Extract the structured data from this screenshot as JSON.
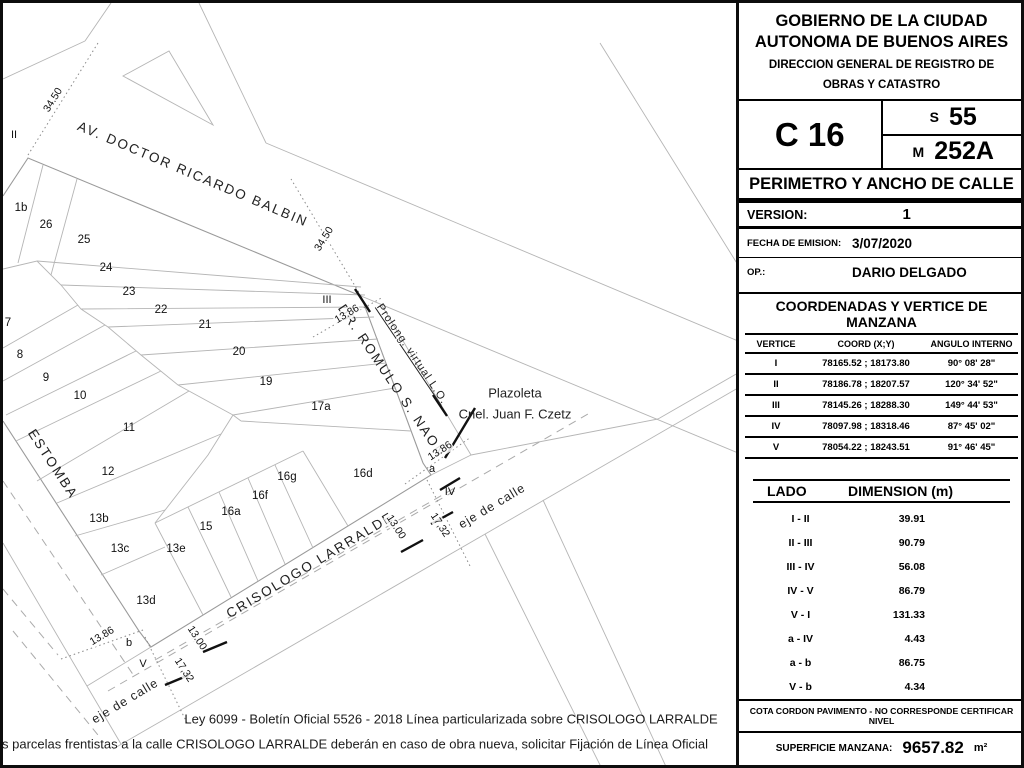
{
  "panel": {
    "org_line1": "GOBIERNO DE LA CIUDAD",
    "org_line2": "AUTONOMA DE BUENOS AIRES",
    "org_line3": "DIRECCION GENERAL DE REGISTRO DE",
    "org_line4": "OBRAS Y CATASTRO",
    "circunscripcion": "C 16",
    "seccion_prefix": "S",
    "seccion": "55",
    "manzana_prefix": "M",
    "manzana": "252A",
    "doc_title": "PERIMETRO Y ANCHO DE CALLE",
    "version_label": "VERSION:",
    "version": "1",
    "fecha_label": "FECHA DE EMISION:",
    "fecha": "3/07/2020",
    "op_label": "OP.:",
    "op": "DARIO DELGADO",
    "coords": {
      "title": "COORDENADAS Y VERTICE DE MANZANA",
      "headers": [
        "VERTICE",
        "COORD (X;Y)",
        "ANGULO INTERNO"
      ],
      "rows": [
        [
          "I",
          "78165.52 ; 18173.80",
          "90° 08' 28\""
        ],
        [
          "II",
          "78186.78 ; 18207.57",
          "120° 34' 52\""
        ],
        [
          "III",
          "78145.26 ; 18288.30",
          "149° 44' 53\""
        ],
        [
          "IV",
          "78097.98 ; 18318.46",
          "87° 45' 02\""
        ],
        [
          "V",
          "78054.22 ; 18243.51",
          "91° 46' 45\""
        ]
      ]
    },
    "lados": {
      "col1": "LADO",
      "col2": "DIMENSION (m)",
      "rows": [
        [
          "I - II",
          "39.91"
        ],
        [
          "II - III",
          "90.79"
        ],
        [
          "III - IV",
          "56.08"
        ],
        [
          "IV - V",
          "86.79"
        ],
        [
          "V - I",
          "131.33"
        ],
        [
          "a - IV",
          "4.43"
        ],
        [
          "a - b",
          "86.75"
        ],
        [
          "V - b",
          "4.34"
        ]
      ]
    },
    "cota": "COTA CORDON PAVIMENTO - NO CORRESPONDE CERTIFICAR NIVEL",
    "superficie_label": "SUPERFICIE MANZANA:",
    "superficie": "9657.82",
    "superficie_unit": "m²"
  },
  "map": {
    "streets": [
      {
        "label": "AV. DOCTOR RICARDO BALBIN",
        "x": 190,
        "y": 171,
        "rot": 23,
        "cls": "street-lg"
      },
      {
        "label": "DR. ROMULO S. NAON",
        "x": 389,
        "y": 378,
        "rot": 56,
        "cls": "street-lg"
      },
      {
        "label": "ESTOMBA",
        "x": 50,
        "y": 461,
        "rot": 57,
        "cls": "street-lg"
      },
      {
        "label": "CRISOLOGO LARRALDE",
        "x": 307,
        "y": 562,
        "rot": -31,
        "cls": "street-lg"
      },
      {
        "label": "eje de calle",
        "x": 489,
        "y": 503,
        "rot": -31,
        "cls": "street-sm"
      },
      {
        "label": "eje de calle",
        "x": 122,
        "y": 698,
        "rot": -31,
        "cls": "street-sm"
      },
      {
        "label": "Prolong. virtual L.O.",
        "x": 409,
        "y": 351,
        "rot": 56,
        "cls": "street-xs underline"
      },
      {
        "label": "Plazoleta",
        "x": 512,
        "y": 390,
        "rot": 0,
        "cls": "street-md"
      },
      {
        "label": "Cnel. Juan F. Czetz",
        "x": 512,
        "y": 411,
        "rot": 0,
        "cls": "street-md"
      }
    ],
    "parcels": [
      {
        "label": "1b",
        "x": 18,
        "y": 205
      },
      {
        "label": "26",
        "x": 43,
        "y": 222
      },
      {
        "label": "25",
        "x": 81,
        "y": 237
      },
      {
        "label": "24",
        "x": 103,
        "y": 265
      },
      {
        "label": "23",
        "x": 126,
        "y": 289
      },
      {
        "label": "22",
        "x": 158,
        "y": 307
      },
      {
        "label": "21",
        "x": 202,
        "y": 322
      },
      {
        "label": "20",
        "x": 236,
        "y": 349
      },
      {
        "label": "19",
        "x": 263,
        "y": 379
      },
      {
        "label": "17a",
        "x": 318,
        "y": 404
      },
      {
        "label": "16d",
        "x": 360,
        "y": 471
      },
      {
        "label": "16g",
        "x": 284,
        "y": 474
      },
      {
        "label": "16f",
        "x": 257,
        "y": 493
      },
      {
        "label": "16a",
        "x": 228,
        "y": 509
      },
      {
        "label": "15",
        "x": 203,
        "y": 524
      },
      {
        "label": "13e",
        "x": 173,
        "y": 546
      },
      {
        "label": "13d",
        "x": 143,
        "y": 598
      },
      {
        "label": "13c",
        "x": 117,
        "y": 546
      },
      {
        "label": "13b",
        "x": 96,
        "y": 516
      },
      {
        "label": "12",
        "x": 105,
        "y": 469
      },
      {
        "label": "11",
        "x": 126,
        "y": 425
      },
      {
        "label": "10",
        "x": 77,
        "y": 393
      },
      {
        "label": "9",
        "x": 43,
        "y": 375
      },
      {
        "label": "8",
        "x": 17,
        "y": 352
      },
      {
        "label": "7",
        "x": 5,
        "y": 320
      }
    ],
    "vertices": [
      {
        "label": "II",
        "x": 11,
        "y": 132
      },
      {
        "label": "III",
        "x": 324,
        "y": 297
      },
      {
        "label": "IV",
        "x": 447,
        "y": 489
      },
      {
        "label": "V",
        "x": 140,
        "y": 661
      },
      {
        "label": "a",
        "x": 429,
        "y": 466
      },
      {
        "label": "b",
        "x": 126,
        "y": 640
      }
    ],
    "dims": [
      {
        "label": "34.50",
        "x": 50,
        "y": 97,
        "rot": -58
      },
      {
        "label": "34.50",
        "x": 321,
        "y": 236,
        "rot": -58
      },
      {
        "label": "13.86",
        "x": 344,
        "y": 311,
        "rot": -31
      },
      {
        "label": "13.86",
        "x": 437,
        "y": 448,
        "rot": -33
      },
      {
        "label": "13.86",
        "x": 99,
        "y": 633,
        "rot": -31
      },
      {
        "label": "13.00",
        "x": 393,
        "y": 524,
        "rot": 57
      },
      {
        "label": "17,32",
        "x": 437,
        "y": 522,
        "rot": 57
      },
      {
        "label": "13.00",
        "x": 194,
        "y": 635,
        "rot": 57
      },
      {
        "label": "17,32",
        "x": 181,
        "y": 667,
        "rot": 57
      }
    ],
    "notes": [
      "Ley 6099 - Boletín Oficial 5526 - 2018 Línea particularizada sobre CRISOLOGO LARRALDE",
      "s parcelas frentistas a la calle CRISOLOGO LARRALDE deberán en caso de obra nueva, solicitar Fijación de Línea Oficial"
    ]
  }
}
